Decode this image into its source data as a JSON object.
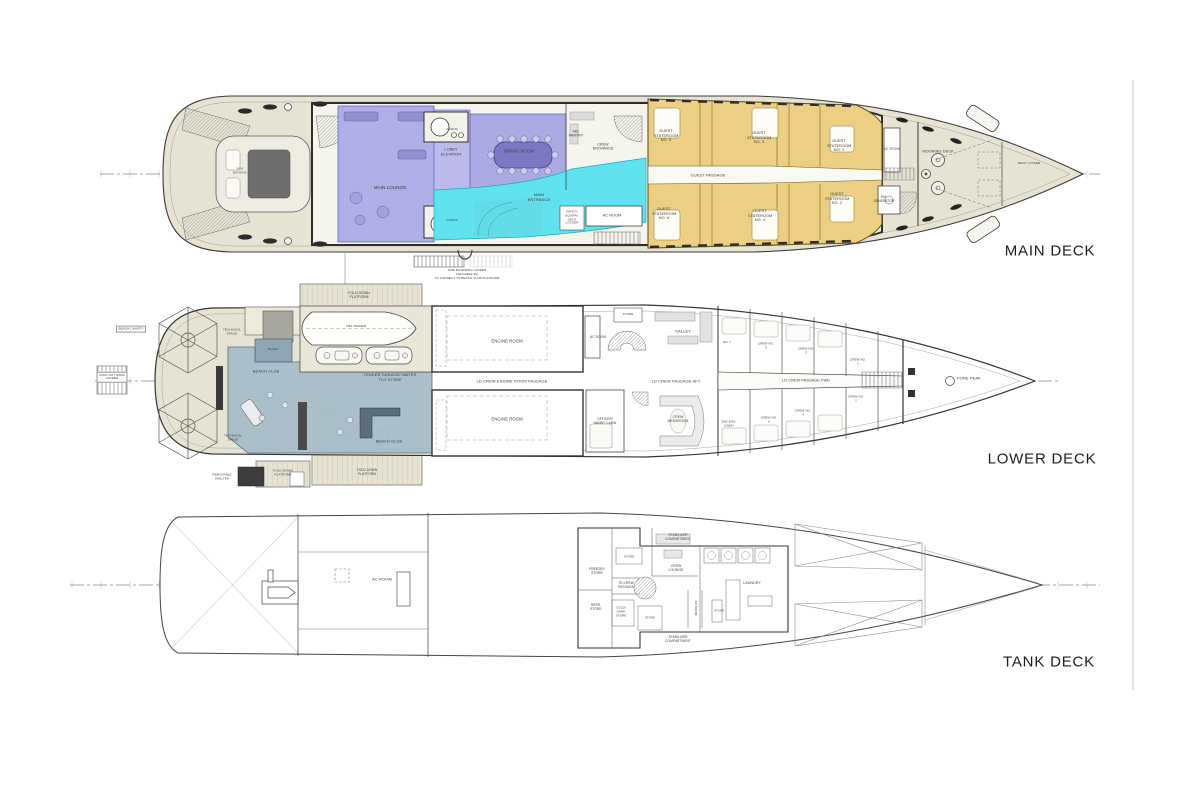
{
  "drawing_type": "yacht deck plans",
  "colors": {
    "deck_teak": "#e7e3d3",
    "superstructure": "#f5f4ed",
    "lounge_purple": "#b0aee6",
    "entrance_cyan": "#5fe2ee",
    "stateroom_gold": "#eccf82",
    "beach_club_blue": "#a7bdca",
    "sauna_blue": "#8fa6b6",
    "line": "#3a3a3a"
  },
  "decks": [
    {
      "id": "main-deck",
      "title": "MAIN DECK",
      "labels": [
        "SUN BATHING",
        "MAIN LOUNGE",
        "LOBBY ELEVATOR",
        "DINING ROOM",
        "CASING",
        "CASING",
        "MD PANTRY",
        "CREW ENTRANCE",
        "MAIN ENTRANCE",
        "AC ROOM",
        "SAFETY EQUIPM. DECK LOCKER",
        "GUEST PASSAGE",
        "GUEST STATEROOM NO. 5",
        "GUEST STATEROOM NO. 3",
        "GUEST STATEROOM NO. 1",
        "GUEST STATEROOM NO. 6",
        "GUEST STATEROOM NO. 4",
        "GUEST STATEROOM NO. 2",
        "AC ROOM",
        "EM. GENERATOR",
        "MOORING DECK",
        "DECK LOCKER",
        "SIDE BOARDING LADDER",
        "FOLDABLE 4M",
        "TO CONNECT TO BEACH CLUB PLATFORM"
      ]
    },
    {
      "id": "lower-deck",
      "title": "LOWER DECK",
      "labels": [
        "FOLD DOWN PLATFORM",
        "10M TENDER",
        "TENDER GARAGE/ WATER TOY STORE",
        "BEACH CANOPY",
        "FOLD OUT SWIM LADDER",
        "SAUNA",
        "BEACH CLUB",
        "BEACH CLUB",
        "TECHNICAL SPACE",
        "TECHNICAL SPACE",
        "REMOVABLE SHELTER",
        "FOLD DOWN PLATFORM",
        "FOLD DOWN PLATFORM",
        "ENGINE ROOM",
        "ENGINE ROOM",
        "LD CREW ENGINE ROOM PASSAGE",
        "AC ROOM",
        "STORE",
        "GALLEY",
        "LD CREW PASSAGE AFT",
        "OFFICER/ NANNY CABIN",
        "CREW MESSROOM",
        "NO. 7",
        "CREW NO. 5",
        "CREW NO. 3",
        "CREW NO. 1",
        "LD CREW PASSAGE FWD",
        "2ND ENG. CABIN",
        "CREW NO. 6",
        "CREW NO. 4",
        "CREW NO. 2",
        "FORE PEAK"
      ]
    },
    {
      "id": "tank-deck",
      "title": "TANK DECK",
      "labels": [
        "AC ROOM",
        "STABILIZER COMPARTMENT",
        "STABILIZER COMPARTMENT",
        "FREEZER STORE",
        "REFR. STORE",
        "TD CREW PASSAGE",
        "COLD/ DARK STORE",
        "STORE",
        "STORE",
        "CREW LOUNGE",
        "AC ROOM",
        "LAUNDRY",
        "STORE"
      ]
    }
  ]
}
